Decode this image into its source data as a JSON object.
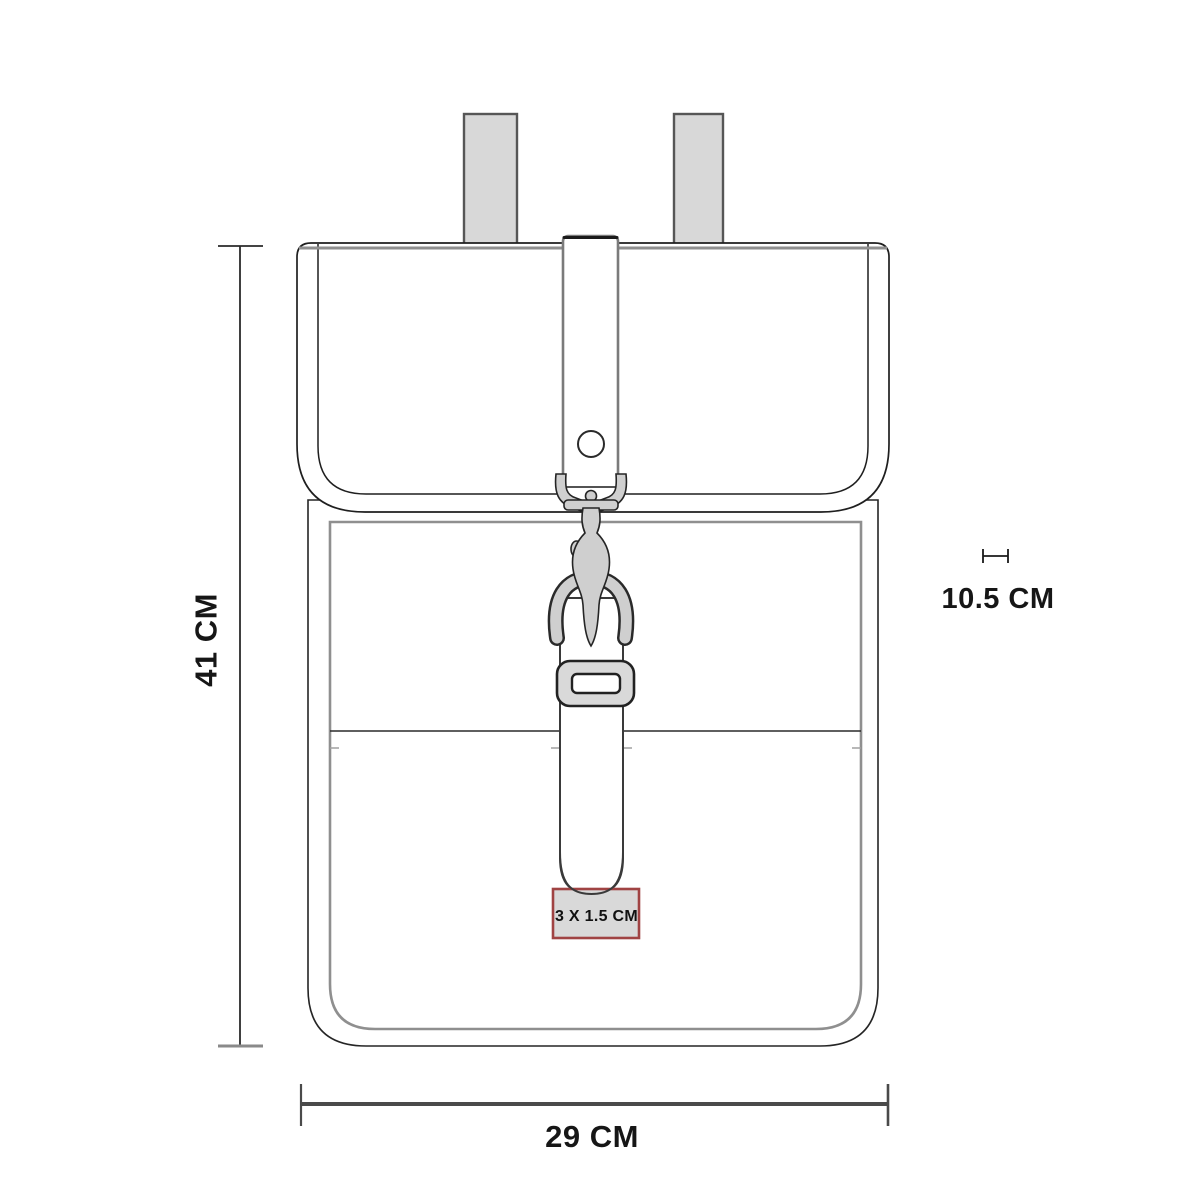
{
  "diagram": {
    "type": "product-dimension-diagram",
    "subject": "mini backpack with carabiner strap closure",
    "dimensions": {
      "height_label": "41 CM",
      "width_label": "29 CM",
      "depth_label": "10.5 CM",
      "branding_area_label": "3 X 1.5 CM"
    },
    "colors": {
      "background": "#ffffff",
      "outline": "#252525",
      "panel_line": "#8f8f8f",
      "strap_fill": "#d8d8d8",
      "hardware_fill": "#cfcfcf",
      "label_box_fill": "#d9d9d9",
      "label_box_border": "#a04343",
      "dimension_line": "#4a4a4a"
    }
  }
}
